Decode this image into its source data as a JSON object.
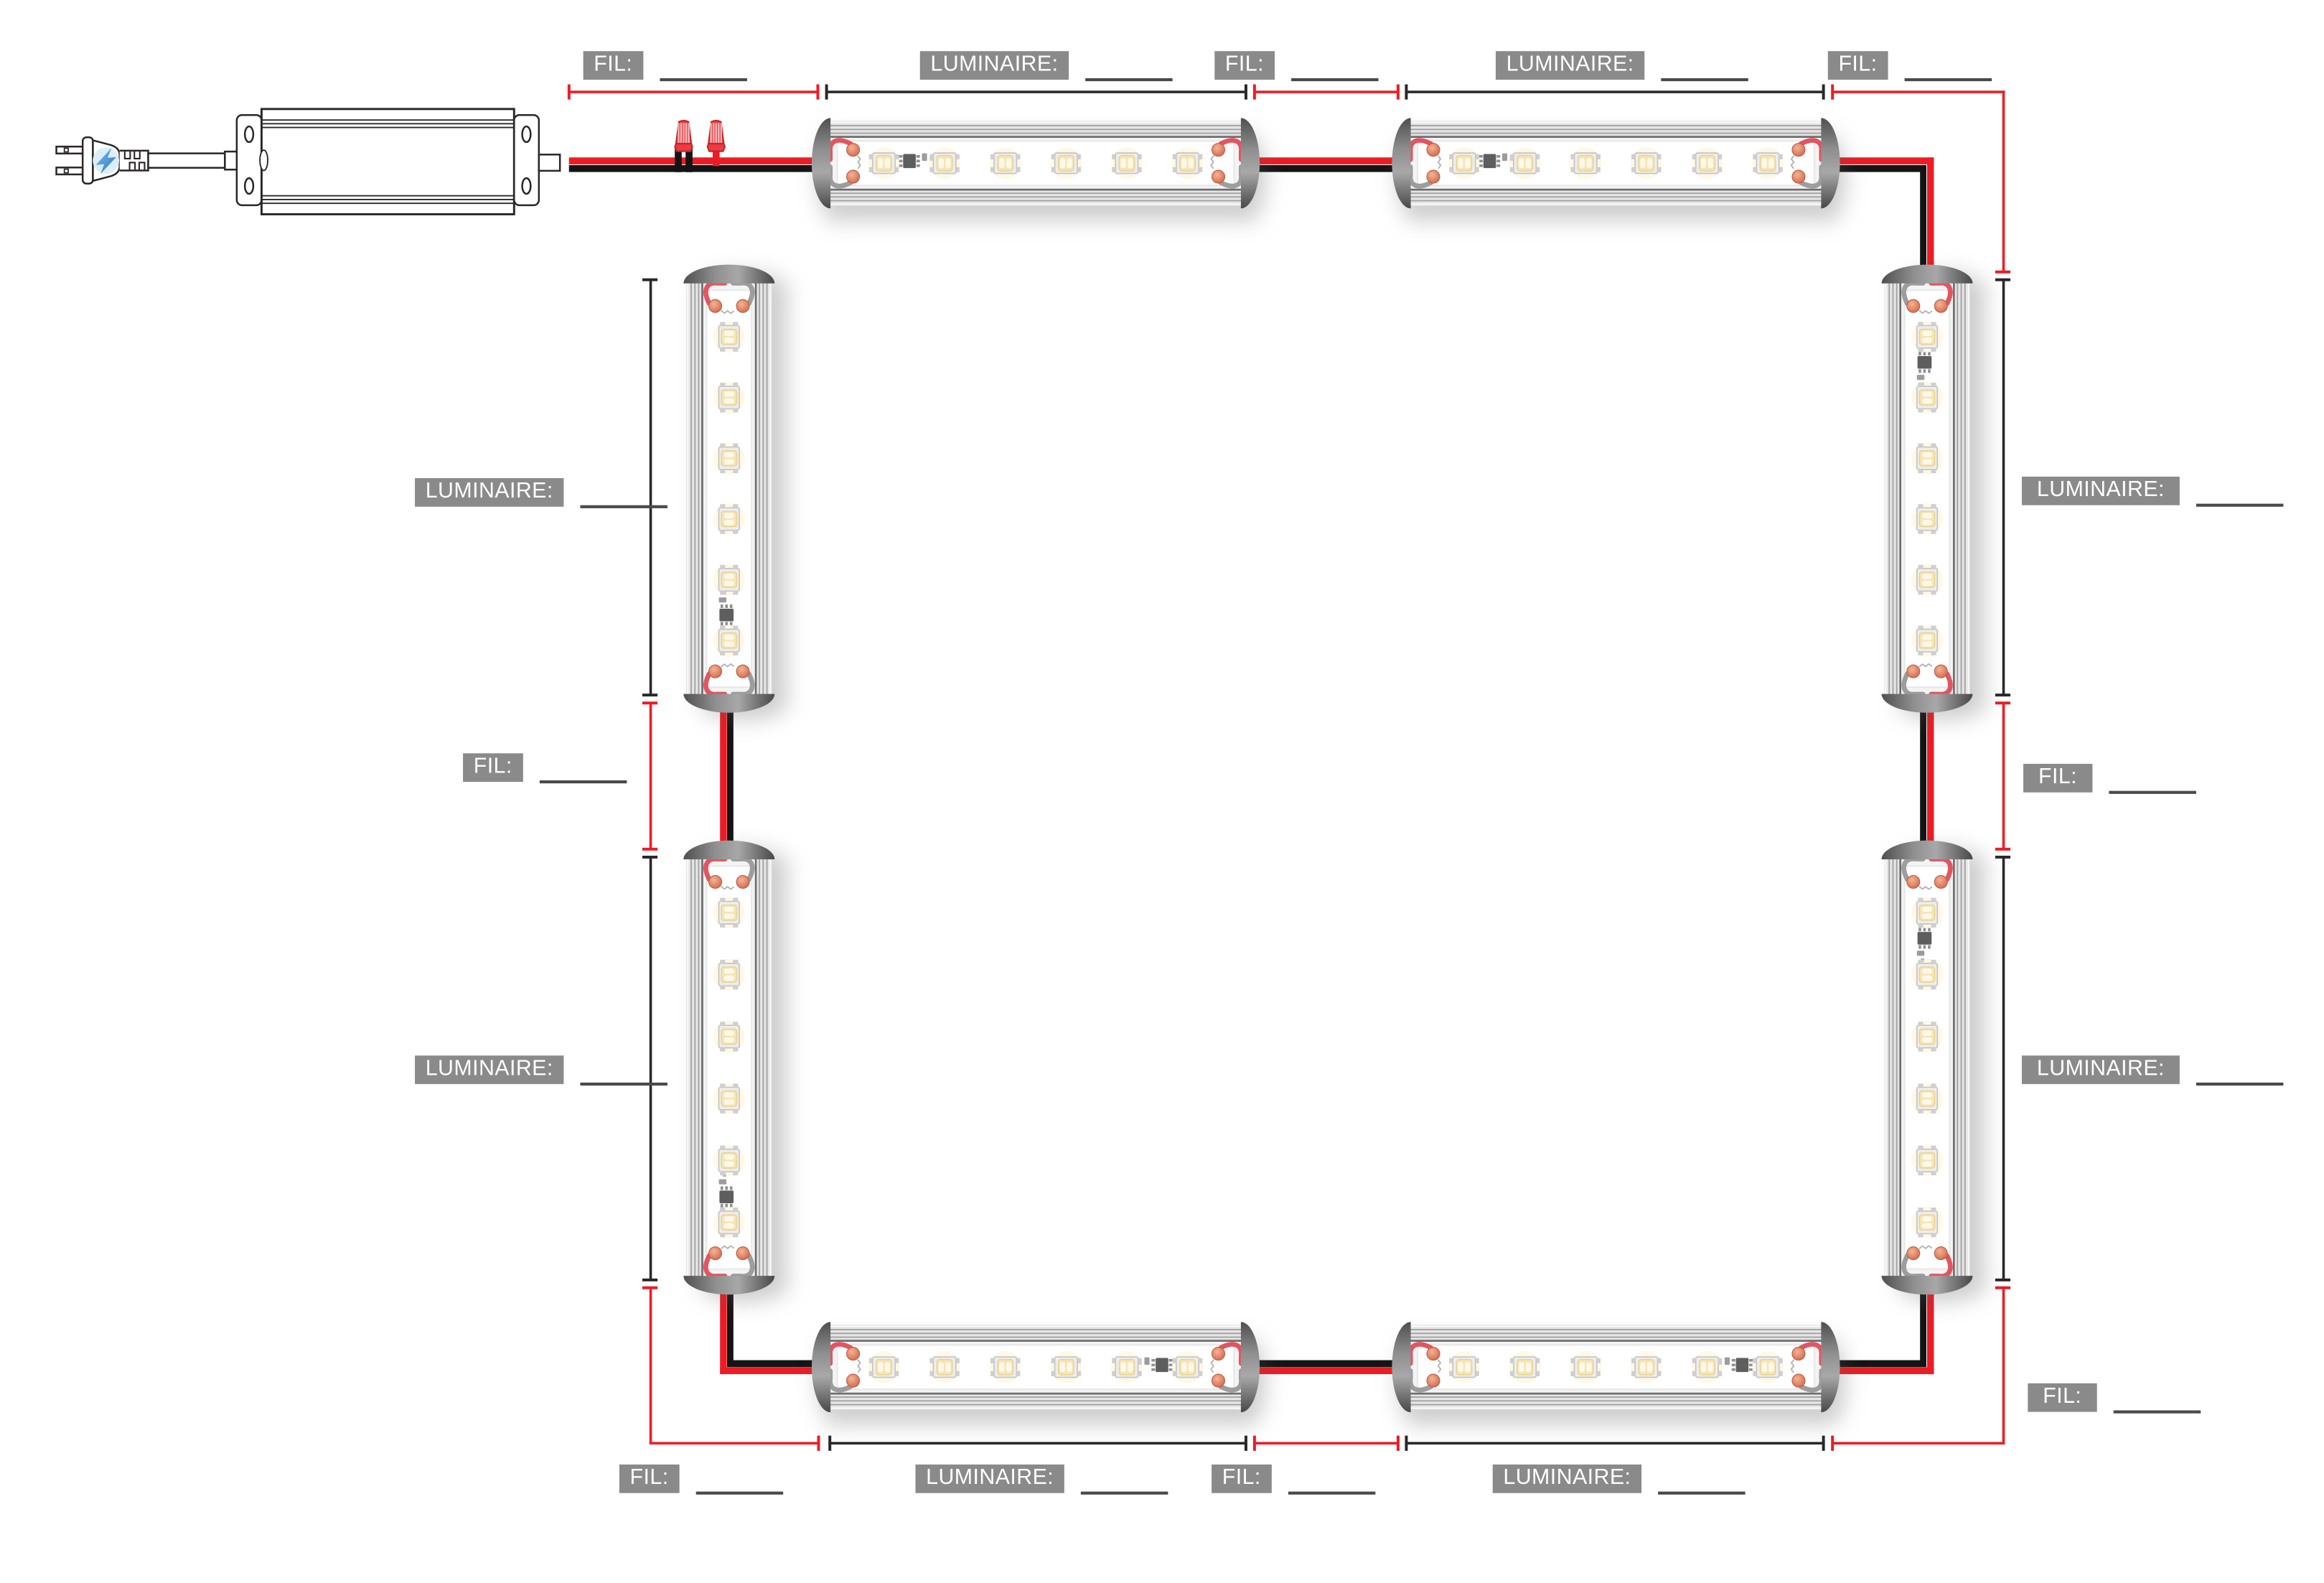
{
  "diagram_type": "led-lighting-wiring-plan",
  "legend": {
    "fil_label": "FIL:",
    "luminaire_label": "LUMINAIRE:"
  },
  "measurements": {
    "fil_driver_to_top_1": "",
    "luminaire_top_1": "",
    "fil_top_mid": "",
    "luminaire_top_2": "",
    "fil_top_right_corner": "",
    "luminaire_right_1": "",
    "fil_right_mid": "",
    "luminaire_right_2": "",
    "fil_right_bottom_corner": "",
    "luminaire_bottom_right": "",
    "fil_bottom_mid": "",
    "luminaire_bottom_left": "",
    "fil_bottom_left_corner": "",
    "luminaire_left_2": "",
    "fil_left_mid": "",
    "luminaire_left_1": ""
  },
  "components": {
    "power_supply": {
      "name": "LED driver with two-prong AC plug",
      "prongs": 2,
      "icon": "lightning-bolt-icon"
    },
    "wire_connectors": {
      "count": 2,
      "icon": "wire-connector-icon"
    },
    "luminaires": {
      "count": 8,
      "leds_per_luminaire": 6
    },
    "wire_runs": {
      "count": 8
    }
  },
  "colors": {
    "background": "#ffffff",
    "wire_positive": "#ed1c24",
    "wire_negative": "#141414",
    "dimension_red": "#ed1c24",
    "dimension_dark": "#2b2728",
    "label_background": "#8a8a8a",
    "label_text": "#ffffff",
    "blank_line": "#4a4a4a",
    "connector_red": "#ee3a40",
    "plug_bolt_blue": "#3f87c9",
    "led_warm": "#f5e5b2"
  }
}
